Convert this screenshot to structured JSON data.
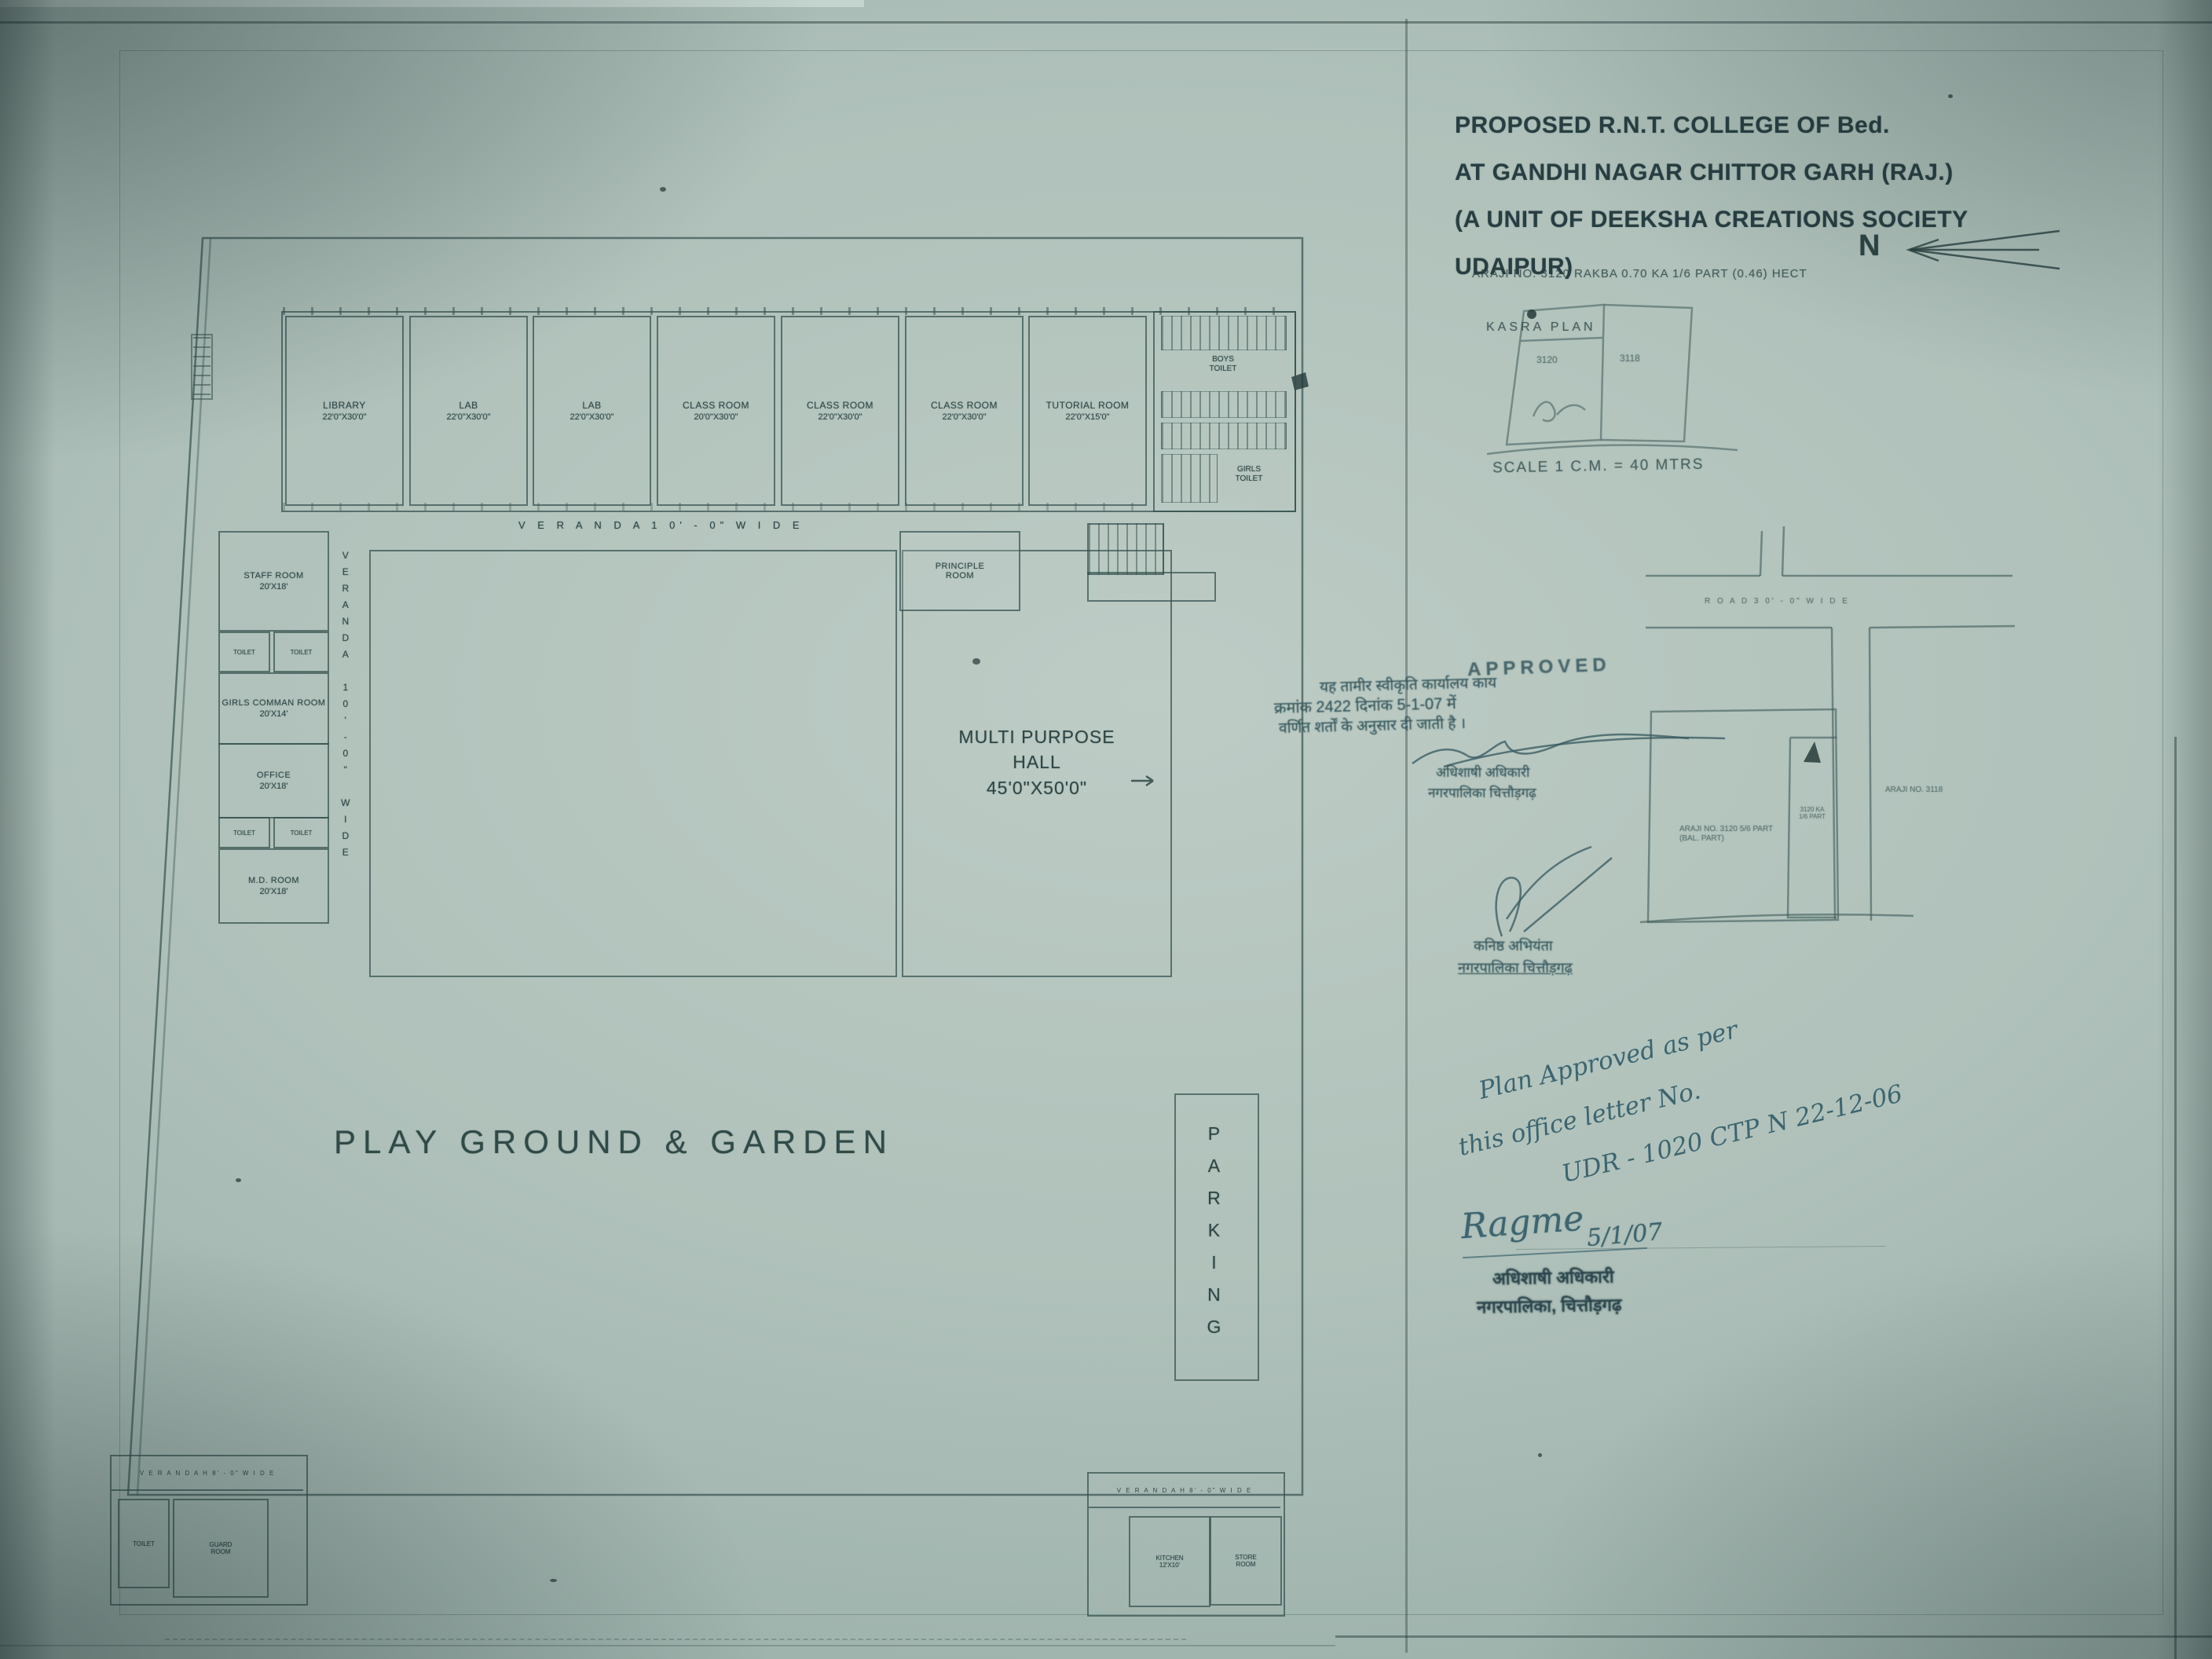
{
  "colors": {
    "paper": "#a7bab4",
    "line": "#34504e",
    "ink": "#26403e",
    "handwriting": "#3d6570"
  },
  "title_block": {
    "line1": "PROPOSED R.N.T. COLLEGE OF Bed.",
    "line2": "AT GANDHI NAGAR CHITTOR GARH (RAJ.)",
    "line3": "(A UNIT OF DEEKSHA CREATIONS SOCIETY  UDAIPUR)",
    "araji_line": "ARAJI NO. 3120  RAKBA 0.70 KA 1/6 PART (0.46) HECT",
    "kasra_plan_label": "KASRA PLAN",
    "north_label": "N",
    "scale_label": "SCALE  1 C.M. = 40 MTRS"
  },
  "kasra_plan": {
    "parcel_left": "3120",
    "parcel_right": "3118"
  },
  "site_plan": {
    "road_label": "R O A D   3 0' - 0\"   W I D E",
    "plot_label_line1": "ARAJI NO. 3120 5/6 PART",
    "plot_label_line2": "(BAL. PART)",
    "inner_plot_line1": "3120 KA",
    "inner_plot_line2": "1/6 PART",
    "right_label": "ARAJI NO. 3118"
  },
  "floor_plan": {
    "veranda_top": "V E R A N D A     1 0' - 0\"     W I D E",
    "veranda_left": "VERANDA  10'-0\"  WIDE",
    "top_rooms": [
      {
        "name": "LIBRARY",
        "dims": "22'0\"X30'0\""
      },
      {
        "name": "LAB",
        "dims": "22'0\"X30'0\""
      },
      {
        "name": "LAB",
        "dims": "22'0\"X30'0\""
      },
      {
        "name": "CLASS ROOM",
        "dims": "20'0\"X30'0\""
      },
      {
        "name": "CLASS ROOM",
        "dims": "22'0\"X30'0\""
      },
      {
        "name": "CLASS ROOM",
        "dims": "22'0\"X30'0\""
      },
      {
        "name": "TUTORIAL ROOM",
        "dims": "22'0\"X15'0\""
      }
    ],
    "toilets": {
      "boys1": "BOYS",
      "boys2": "TOILET",
      "girls1": "GIRLS",
      "girls2": "TOILET"
    },
    "left_rooms": [
      {
        "name": "STAFF ROOM",
        "dims": "20'X18'"
      },
      {
        "name": "GIRLS COMMAN ROOM",
        "dims": "20'X14'"
      },
      {
        "name": "OFFICE",
        "dims": "20'X18'"
      },
      {
        "name": "M.D. ROOM",
        "dims": "20'X18'"
      }
    ],
    "toilet_cell": "TOILET",
    "principle1": "PRINCIPLE",
    "principle2": "ROOM",
    "hall1": "MULTI PURPOSE",
    "hall2": "HALL",
    "hall3": "45'0\"X50'0\"",
    "playground": "PLAY GROUND & GARDEN",
    "parking": "PARKING",
    "gate_verandah": "V E R A N D A H   8' - 0\"   W I D E",
    "gate_blocks": {
      "left": {
        "room1": [
          "TOILET",
          ""
        ],
        "room2": [
          "GUARD",
          "ROOM"
        ]
      },
      "right": {
        "room1": [
          "KITCHEN",
          "12'X10'"
        ],
        "room2": [
          "STORE",
          "ROOM"
        ]
      }
    }
  },
  "approved_stamp": {
    "title": "APPROVED",
    "hindi1": "यह तामीर स्वीकृति कार्यालय काय",
    "hindi2": "क्रमांक 2422 दिनांक 5-1-07 में",
    "hindi3": "वर्णित शर्तों के अनुसार दी जाती है ।",
    "officer1": "अधिशाषी अधिकारी",
    "officer2": "नगरपालिका चित्तौड़गढ़"
  },
  "je_stamp": {
    "line1": "कनिष्ठ अभियंता",
    "line2": "नगरपालिका चित्तौड़गढ़"
  },
  "handwritten": {
    "line1": "Plan Approved as per",
    "line2": "this office letter No.",
    "line3": "UDR - 1020 CTP N 22-12-06",
    "signature": "Ragme",
    "date": "5/1/07"
  },
  "eo_stamp": {
    "line1": "अधिशाषी अधिकारी",
    "line2": "नगरपालिका, चित्तौड़गढ़"
  }
}
